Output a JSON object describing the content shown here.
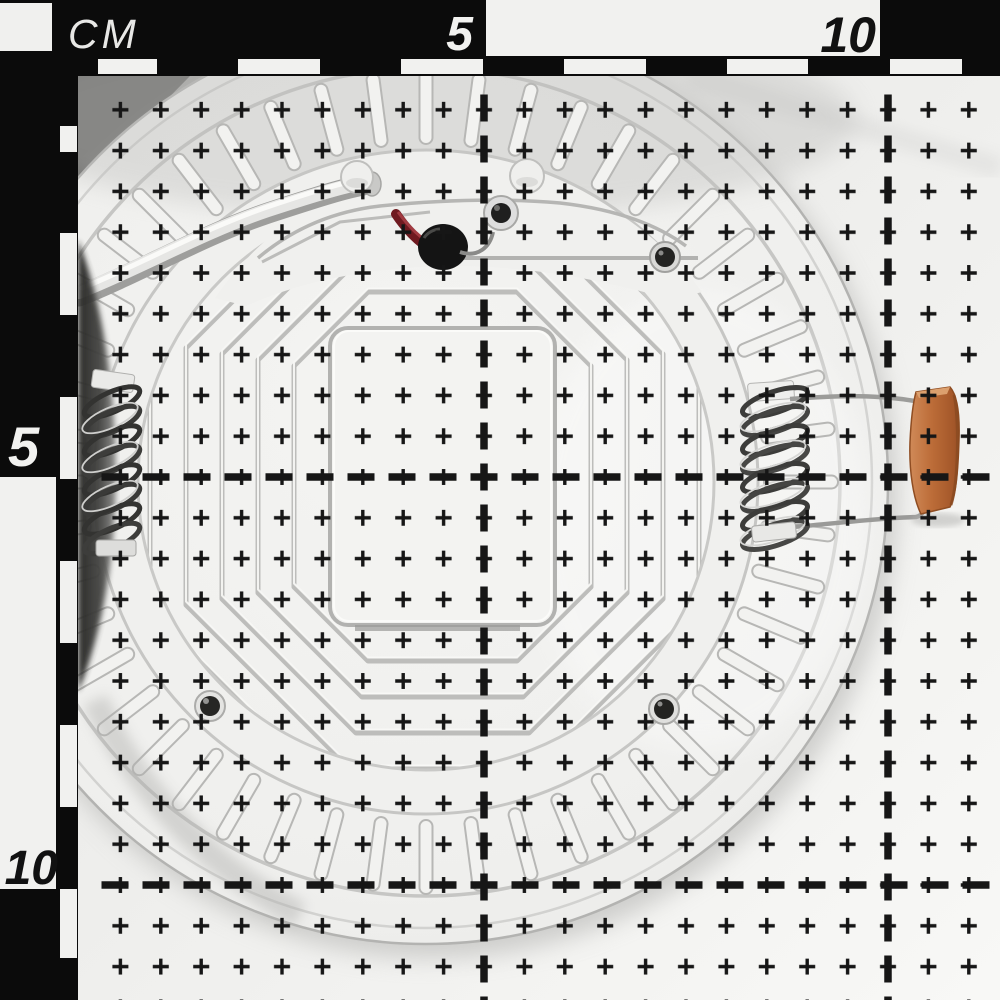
{
  "photo_frame": {
    "unit_label": "CM",
    "top_scale": {
      "labels": [
        "5",
        "10"
      ]
    },
    "left_scale": {
      "labels": [
        "5",
        "10"
      ]
    }
  },
  "grid": {
    "cross_rows": "0.5 cm cross lattice over entire photo",
    "heavy_dashed_lines_cm": [
      5,
      10
    ],
    "ink_color": "#161616"
  },
  "scene": {
    "subject": "rear side of a round white LED downlight panel photographed on a centimetre scale grid",
    "components": [
      "power-cable",
      "red-lead-wire",
      "black-connector",
      "terminal-screw",
      "rim-screws",
      "mounting-spring-left",
      "mounting-spring-right",
      "orange-film-capacitor",
      "radial-rib-ring",
      "concentric-octagon-grooves",
      "central-plate"
    ]
  },
  "colors": {
    "scale_black": "#0b0b0b",
    "scale_white": "#f1f1ef",
    "paper": "#efefed",
    "device_body": "#f0f0ee",
    "groove_gray": "#bdbdbb",
    "spring_metal": "#3c3c3a",
    "capacitor_orange": "#bc6c38",
    "wire_red": "#6f1a20",
    "connector_black": "#141414"
  }
}
